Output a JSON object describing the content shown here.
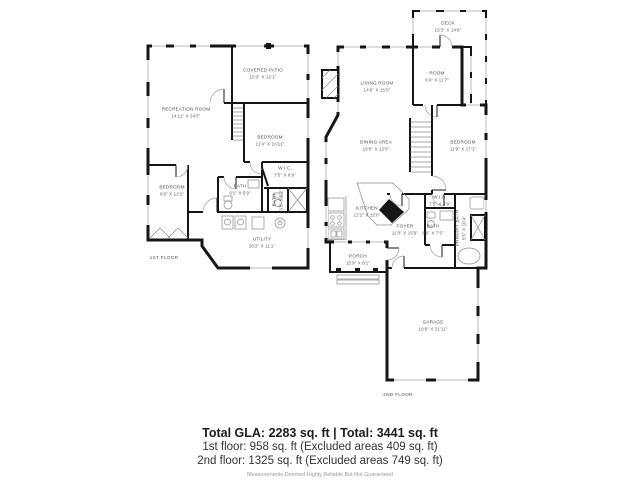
{
  "floor1": {
    "label": "1ST FLOOR",
    "rooms": [
      {
        "name": "COVERED PATIO",
        "dims": "15'3\" X 12'1\""
      },
      {
        "name": "RECREATION ROOM",
        "dims": "14'11\" X 34'3\""
      },
      {
        "name": "BEDROOM",
        "dims": "11'4\" X 16'11\""
      },
      {
        "name": "W.I.C.",
        "dims": "7'5\" X 8'9\""
      },
      {
        "name": "BATH",
        "dims": "9'1\" X 5'9\""
      },
      {
        "name": "BEDROOM",
        "dims": "9'9\" X 12'2\""
      },
      {
        "name": "UTILITY",
        "dims": "20'2\" X 11'1\""
      },
      {
        "name": "BATH",
        "dims": "3'5\" X 5'2\""
      }
    ]
  },
  "floor2": {
    "label": "2ND FLOOR",
    "rooms": [
      {
        "name": "DECK",
        "dims": "15'3\" X 14'8\""
      },
      {
        "name": "LIVING ROOM",
        "dims": "14'6\" X 15'0\""
      },
      {
        "name": "ROOM",
        "dims": "9'4\" X 11'7\""
      },
      {
        "name": "DINING AREA",
        "dims": "19'0\" X 12'0\""
      },
      {
        "name": "BEDROOM",
        "dims": "11'9\" X 17'1\""
      },
      {
        "name": "KITCHEN",
        "dims": "12'2\" X 12'0\""
      },
      {
        "name": "W.I.C.",
        "dims": "7'5\" X 4'9\""
      },
      {
        "name": "BATH",
        "dims": "8'5\" X 7'5\""
      },
      {
        "name": "FOYER",
        "dims": "11'0\" X 15'9\""
      },
      {
        "name": "PRIMARY BATH",
        "dims": "5'5\" X 10'4\""
      },
      {
        "name": "PORCH",
        "dims": "15'9\" X 8'1\""
      },
      {
        "name": "GARAGE",
        "dims": "19'8\" X 21'11\""
      }
    ]
  },
  "summary": {
    "line1": "Total GLA: 2283 sq. ft | Total: 3441 sq. ft",
    "line2": "1st floor: 958 sq. ft (Excluded areas 409 sq. ft)",
    "line3": "2nd floor: 1325 sq. ft (Excluded areas 749 sq. ft)",
    "disclaimer": "Measurements Deemed Highly Reliable But Not Guaranteed"
  }
}
